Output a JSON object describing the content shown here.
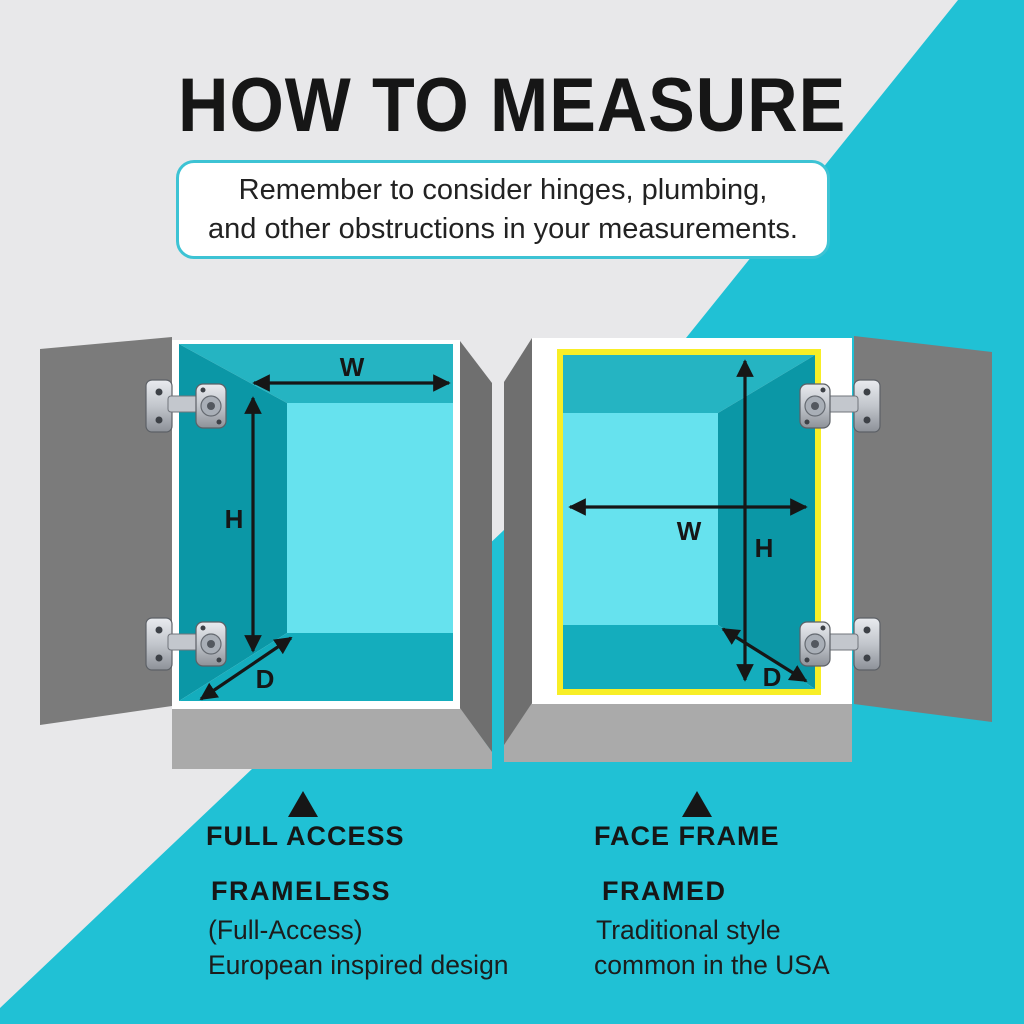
{
  "title": "HOW TO MEASURE",
  "note": {
    "line1": "Remember to consider hinges, plumbing,",
    "line2": "and other obstructions in your measurements."
  },
  "cabinets": {
    "left": {
      "dims": {
        "w": "W",
        "h": "H",
        "d": "D"
      },
      "caption": "FULL ACCESS",
      "label": "FRAMELESS",
      "detail1": "(Full-Access)",
      "detail2": "European inspired design"
    },
    "right": {
      "dims": {
        "w": "W",
        "h": "H",
        "d": "D"
      },
      "caption": "FACE FRAME",
      "label": "FRAMED",
      "detail1": "Traditional style",
      "detail2": "common in the USA"
    }
  },
  "colors": {
    "background": "#e8e8ea",
    "accent_cyan": "#20c1d5",
    "note_border": "#3dc3d4",
    "door_gray": "#7b7b7b",
    "side_gray": "#6f6f6f",
    "platform_gray": "#aaaaaa",
    "interior_top": "#25b4c2",
    "interior_wall": "#0b97a6",
    "interior_bottom": "#14adbd",
    "interior_back": "#66e2ee",
    "frame_yellow": "#f8ee26",
    "text_black": "#161616"
  }
}
